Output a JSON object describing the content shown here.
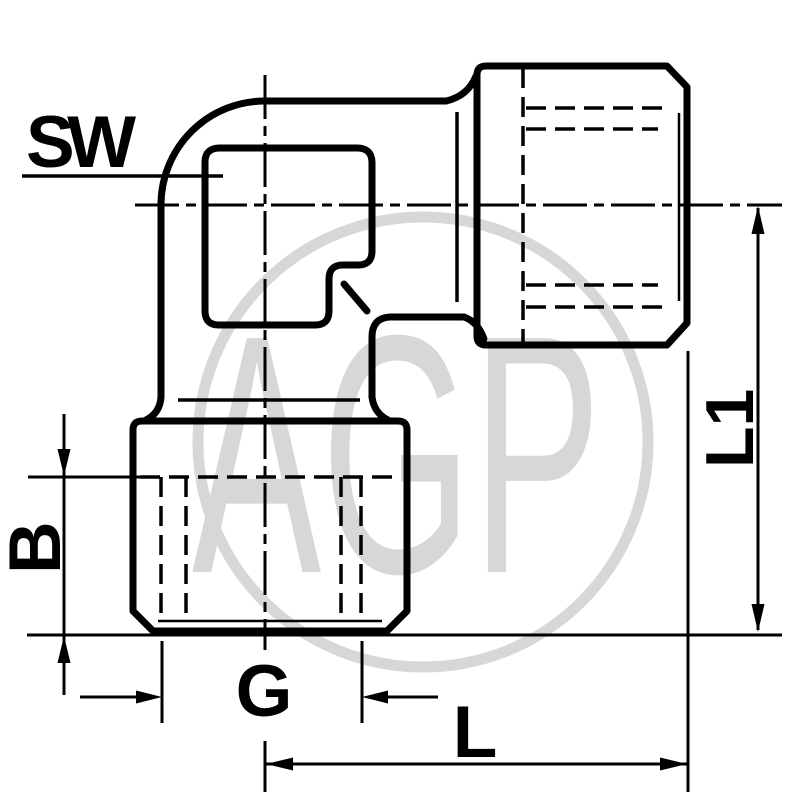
{
  "drawing": {
    "title": "elbow-fitting-dimension-drawing",
    "labels": {
      "sw": "SW",
      "b": "B",
      "g": "G",
      "l": "L",
      "l1": "L1"
    },
    "watermark": {
      "text": "AGP",
      "color": "#d7d7d7"
    },
    "colors": {
      "line": "#000000",
      "background": "#ffffff"
    }
  }
}
